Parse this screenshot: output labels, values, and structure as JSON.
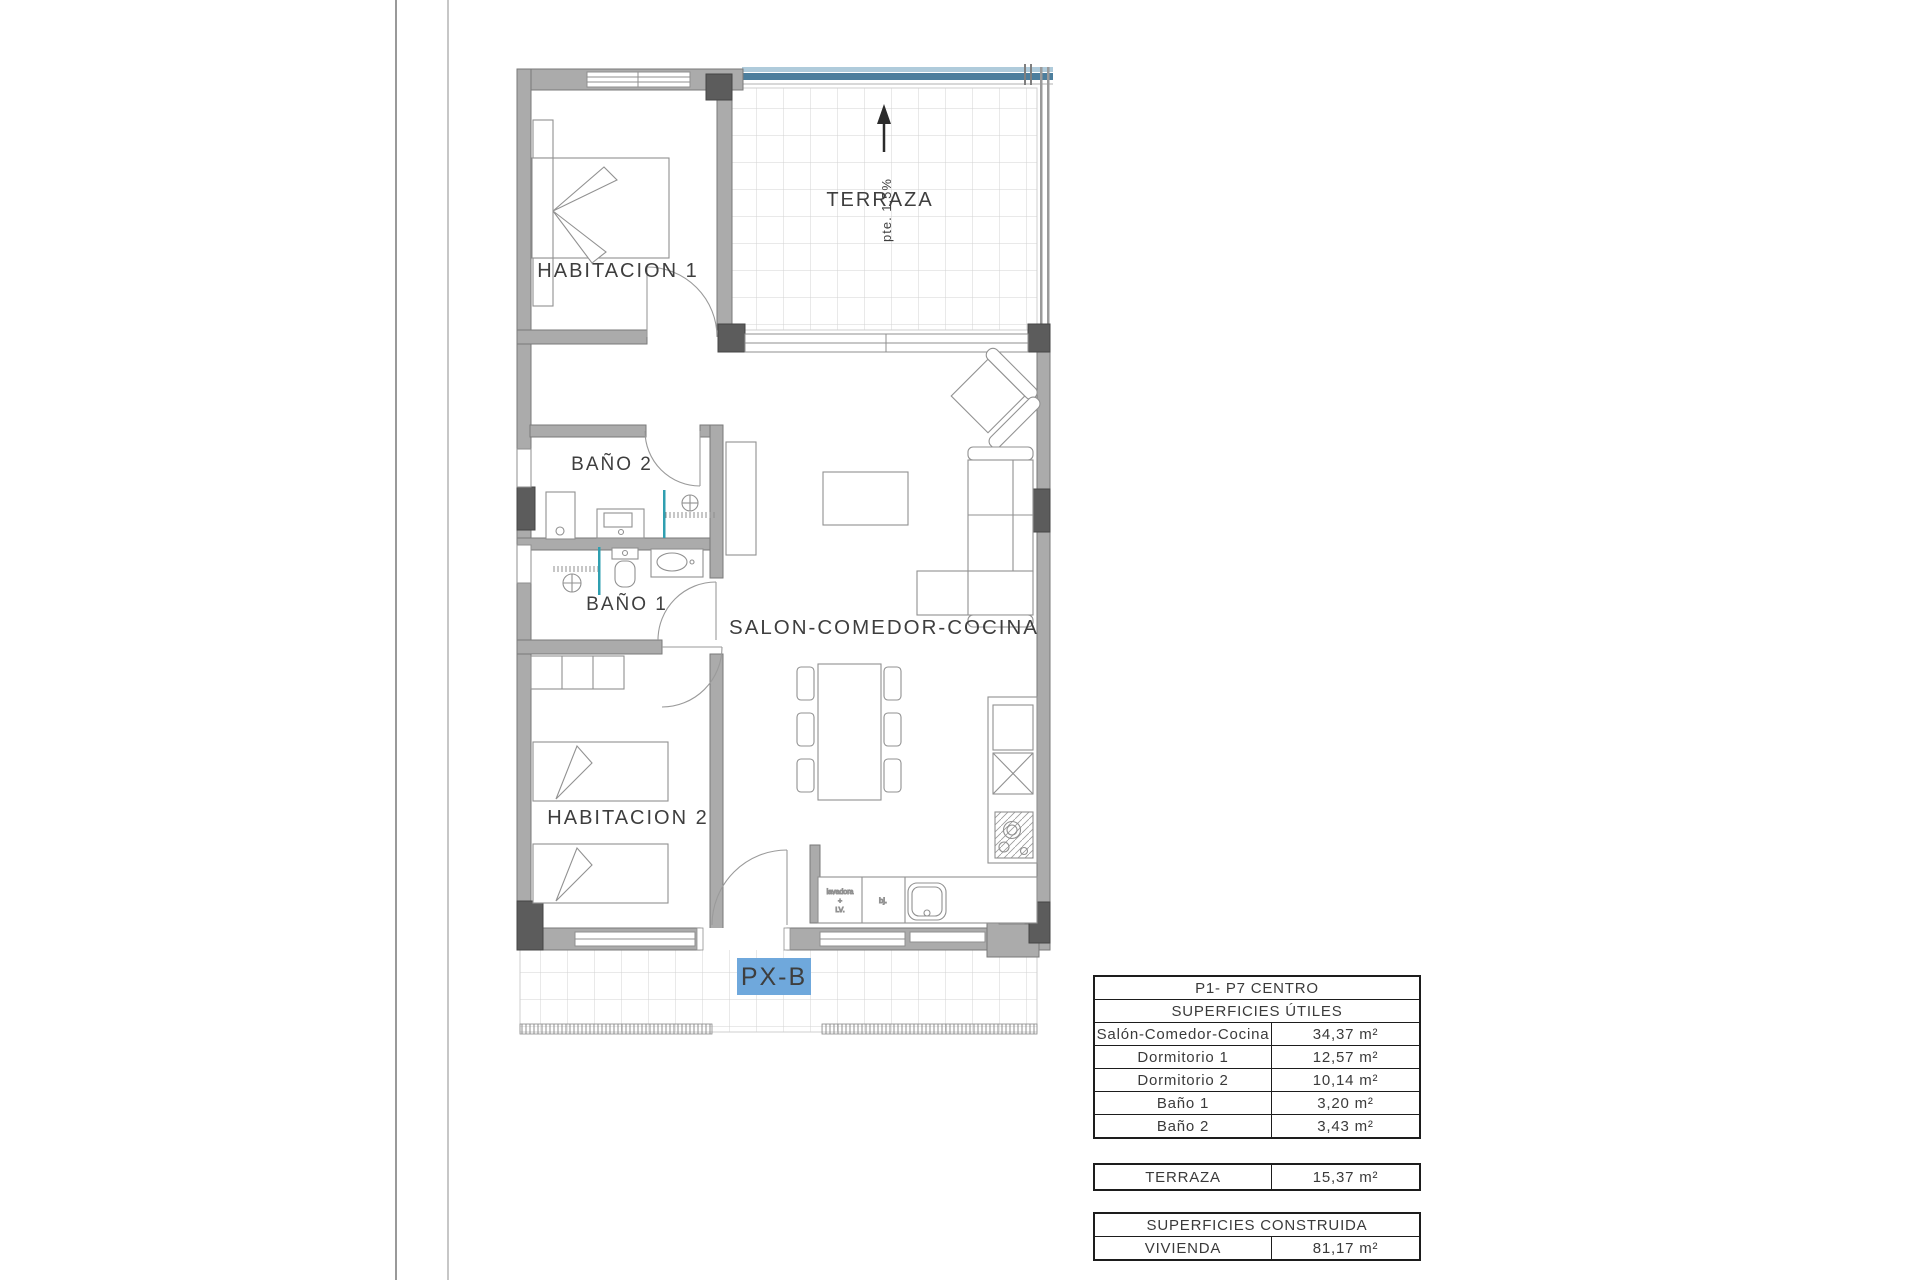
{
  "plan": {
    "unit_tag": "PX-B",
    "slope_note": "pte. 1,5%",
    "labels": {
      "habitacion1": "HABITACION 1",
      "terraza": "TERRAZA",
      "bano2": "BAÑO 2",
      "bano1": "BAÑO 1",
      "habitacion2": "HABITACION 2",
      "salon": "SALON-COMEDOR-COCINA"
    },
    "kitchen": {
      "washer_line1": "lavadora",
      "washer_line2": "+",
      "washer_line3": "LV.",
      "bj": "bj."
    },
    "colors": {
      "unit_tag_bg": "#6fa8dc",
      "terrace_railing": "#4c7e9d",
      "shower_screen": "#2f9fb0"
    }
  },
  "tables": {
    "utiles": {
      "title": "P1- P7 CENTRO",
      "subtitle": "SUPERFICIES ÚTILES",
      "rows": [
        {
          "label": "Salón-Comedor-Cocina",
          "value": "34,37 m²"
        },
        {
          "label": "Dormitorio 1",
          "value": "12,57 m²"
        },
        {
          "label": "Dormitorio 2",
          "value": "10,14 m²"
        },
        {
          "label": "Baño 1",
          "value": "3,20 m²"
        },
        {
          "label": "Baño 2",
          "value": "3,43 m²"
        }
      ]
    },
    "terraza": {
      "rows": [
        {
          "label": "TERRAZA",
          "value": "15,37 m²"
        }
      ]
    },
    "construida": {
      "title": "SUPERFICIES CONSTRUIDA",
      "rows": [
        {
          "label": "VIVIENDA",
          "value": "81,17 m²"
        }
      ]
    }
  }
}
